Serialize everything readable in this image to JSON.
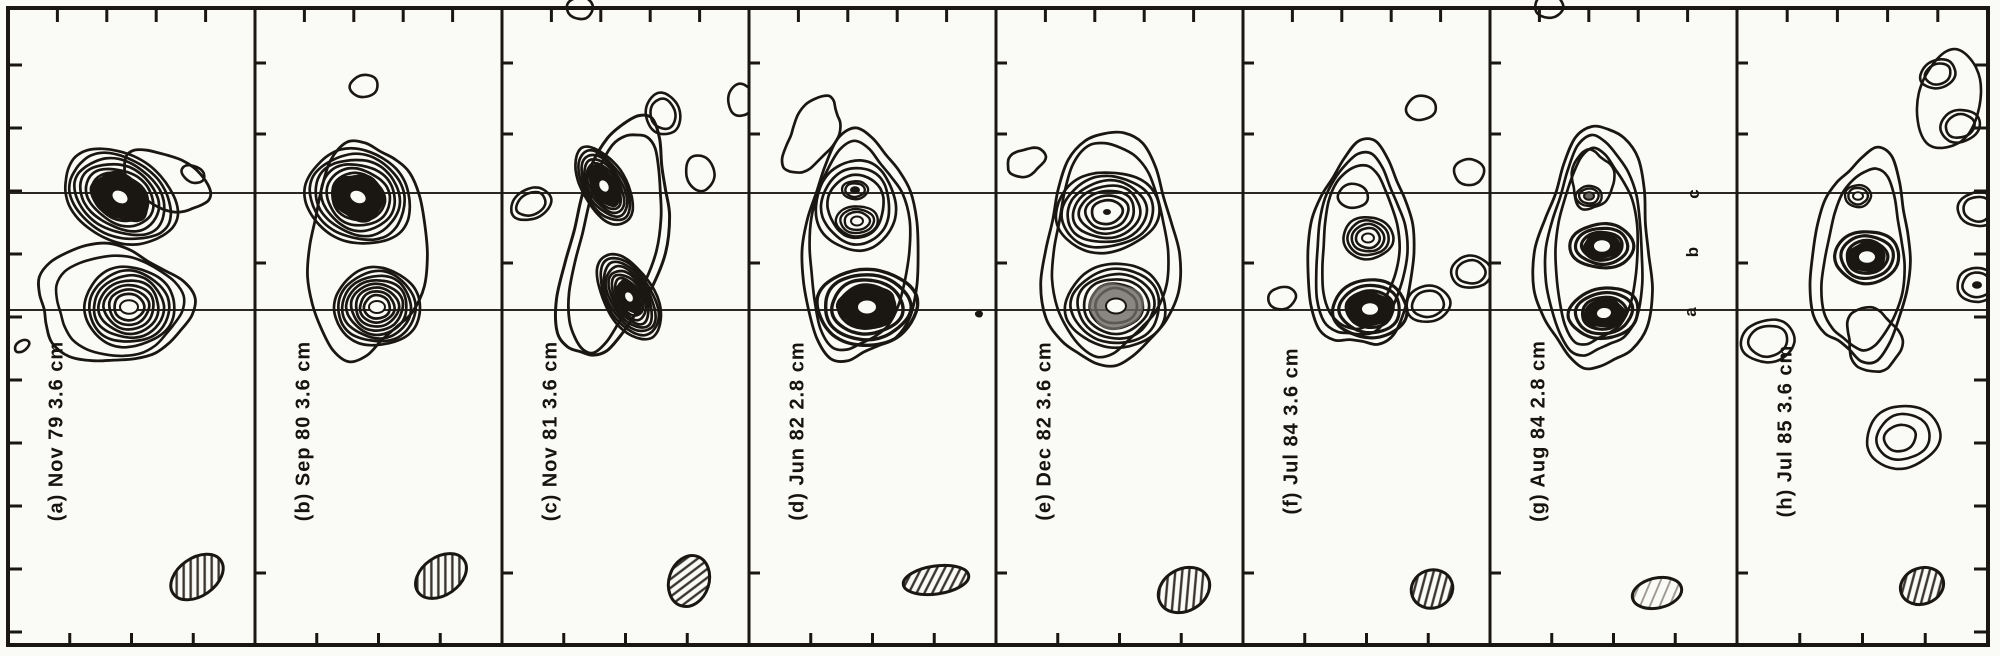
{
  "figure": {
    "title": "Multi-epoch VLBI contour maps, panels (a)-(h)",
    "colors": {
      "ink": "#1a1712",
      "paper": "#fafaf7",
      "gray": "#6e6a64",
      "refline": "#2b2823",
      "hatch": "#3a352e",
      "hatch_light": "#9a958d"
    }
  },
  "chart_data": {
    "type": "contour-map-series",
    "title": "Eight epoch radio interferometry contour maps of a compact double/triple source",
    "component_letters": [
      {
        "text": "c",
        "x": 1694,
        "y": 194
      },
      {
        "text": "b",
        "x": 1693,
        "y": 252
      },
      {
        "text": "a",
        "x": 1691,
        "y": 312
      }
    ],
    "reference_lines": {
      "y": [
        193,
        310
      ],
      "x0": 8,
      "x1": 1988
    },
    "axes": {
      "border": {
        "x0": 8,
        "y0": 8,
        "x1": 1988,
        "y1": 645
      },
      "panel_borders_x": [
        8,
        255,
        502,
        749,
        996,
        1243,
        1490,
        1737,
        1988
      ],
      "top_tick_fracs": [
        0.2,
        0.4,
        0.6,
        0.8
      ],
      "bottom_tick_fracs": [
        0.25,
        0.5,
        0.75
      ],
      "edge_tick_start": 65,
      "edge_tick_step": 63,
      "edge_tick_count": 10,
      "inner_border_ticks_y": [
        63,
        134,
        263,
        573
      ]
    },
    "panels": [
      {
        "id": "a",
        "label": "(a) Nov 79  3.6 cm",
        "epoch": "Nov 79",
        "wavelength": "3.6 cm",
        "label_pos": {
          "x": 57,
          "y": 431
        },
        "env": [
          {
            "cx": 112,
            "cy": 304,
            "rx": 77,
            "ry": 58,
            "rot": 8,
            "amp": 0.11,
            "sw": 2.8
          },
          {
            "cx": 118,
            "cy": 305,
            "rx": 63,
            "ry": 50,
            "rot": 5,
            "amp": 0.07,
            "sw": 2.6
          },
          {
            "cx": 166,
            "cy": 181,
            "rx": 46,
            "ry": 26,
            "rot": 25,
            "amp": 0.07,
            "sw": 2.8
          }
        ],
        "src": [
          {
            "cx": 120,
            "cy": 197,
            "rx": 60,
            "ry": 43,
            "rot": 30,
            "rings": 7,
            "min": 0.3,
            "dark": 0.52,
            "core": "white",
            "coreR": 9,
            "sw": 2.7
          },
          {
            "cx": 129,
            "cy": 307,
            "rx": 45,
            "ry": 40,
            "rot": 0,
            "rings": 7,
            "min": 0.22,
            "core": "white",
            "coreR": 9,
            "sw": 2.7
          }
        ],
        "iso": [
          {
            "cx": 193,
            "cy": 174,
            "rx": 12,
            "ry": 8,
            "rot": 25,
            "rings": 1
          },
          {
            "cx": 22,
            "cy": 346,
            "rx": 8,
            "ry": 5,
            "rot": -35,
            "rings": 1
          }
        ],
        "beam": {
          "cx": 197,
          "cy": 577,
          "rx": 29,
          "ry": 19,
          "rot": -35,
          "hatch": "dark"
        }
      },
      {
        "id": "b",
        "label": "(b) Sep 80  3.6 cm",
        "epoch": "Sep 80",
        "wavelength": "3.6 cm",
        "label_pos": {
          "x": 304,
          "y": 431
        },
        "env": [
          {
            "cx": 366,
            "cy": 250,
            "rx": 59,
            "ry": 107,
            "rot": 4,
            "amp": 0.1,
            "sw": 2.8
          }
        ],
        "src": [
          {
            "cx": 358,
            "cy": 197,
            "rx": 54,
            "ry": 46,
            "rot": 25,
            "rings": 7,
            "min": 0.3,
            "dark": 0.5,
            "core": "white",
            "coreR": 9,
            "sw": 2.7
          },
          {
            "cx": 377,
            "cy": 307,
            "rx": 43,
            "ry": 39,
            "rot": 0,
            "rings": 8,
            "min": 0.2,
            "core": "white",
            "coreR": 8,
            "sw": 2.7
          }
        ],
        "iso": [
          {
            "cx": 364,
            "cy": 86,
            "rx": 14,
            "ry": 11,
            "rot": -10,
            "rings": 1
          }
        ],
        "beam": {
          "cx": 441,
          "cy": 576,
          "rx": 28,
          "ry": 19,
          "rot": -35,
          "hatch": "dark"
        }
      },
      {
        "id": "c",
        "label": "(c) Nov 81  3.6 cm",
        "epoch": "Nov 81",
        "wavelength": "3.6 cm",
        "label_pos": {
          "x": 551,
          "y": 431
        },
        "env": [
          {
            "cx": 615,
            "cy": 240,
            "rx": 47,
            "ry": 123,
            "rot": 14,
            "amp": 0.12,
            "sw": 3.0
          },
          {
            "cx": 616,
            "cy": 241,
            "rx": 38,
            "ry": 112,
            "rot": 14,
            "amp": 0.1,
            "sw": 2.8
          }
        ],
        "src": [
          {
            "cx": 604,
            "cy": 186,
            "rx": 43,
            "ry": 22,
            "rot": 60,
            "rings": 7,
            "min": 0.28,
            "dark": 0.55,
            "core": "white",
            "coreR": 7,
            "sw": 2.7
          },
          {
            "cx": 629,
            "cy": 297,
            "rx": 47,
            "ry": 25,
            "rot": 60,
            "rings": 8,
            "min": 0.25,
            "dark": 0.4,
            "core": "white",
            "coreR": 6,
            "sw": 2.7
          }
        ],
        "iso": [
          {
            "cx": 663,
            "cy": 114,
            "rx": 17,
            "ry": 21,
            "rot": -15,
            "rings": 2
          },
          {
            "cx": 700,
            "cy": 173,
            "rx": 14,
            "ry": 18,
            "rot": -12,
            "rings": 1
          },
          {
            "cx": 531,
            "cy": 204,
            "rx": 21,
            "ry": 15,
            "rot": -25,
            "rings": 2
          },
          {
            "cx": 741,
            "cy": 100,
            "rx": 13,
            "ry": 16,
            "rot": 0,
            "rings": 1
          },
          {
            "cx": 580,
            "cy": 8,
            "rx": 13,
            "ry": 11,
            "rot": 0,
            "rings": 1
          }
        ],
        "beam": {
          "cx": 689,
          "cy": 581,
          "rx": 20,
          "ry": 26,
          "rot": 18,
          "hatch": "dark"
        }
      },
      {
        "id": "d",
        "label": "(d) Jun 82  2.8 cm",
        "epoch": "Jun 82",
        "wavelength": "2.8 cm",
        "label_pos": {
          "x": 798,
          "y": 431
        },
        "env": [
          {
            "cx": 860,
            "cy": 250,
            "rx": 58,
            "ry": 113,
            "rot": 2,
            "amp": 0.1,
            "sw": 2.8
          },
          {
            "cx": 858,
            "cy": 248,
            "rx": 50,
            "ry": 102,
            "rot": 2,
            "amp": 0.085,
            "sw": 2.7
          },
          {
            "cx": 812,
            "cy": 135,
            "rx": 22,
            "ry": 42,
            "rot": 28,
            "amp": 0.13,
            "sw": 2.7
          }
        ],
        "src": [
          {
            "cx": 856,
            "cy": 206,
            "rx": 40,
            "ry": 45,
            "rot": 0,
            "rings": 3,
            "min": 0.55,
            "sw": 2.7
          },
          {
            "cx": 855,
            "cy": 190,
            "rx": 13,
            "ry": 9,
            "rot": 0,
            "rings": 2,
            "min": 0.5,
            "core": "dot",
            "coreR": 5,
            "sw": 2.4
          },
          {
            "cx": 857,
            "cy": 221,
            "rx": 21,
            "ry": 15,
            "rot": 0,
            "rings": 3,
            "min": 0.4,
            "core": "white",
            "coreR": 6,
            "sw": 2.4
          },
          {
            "cx": 867,
            "cy": 307,
            "rx": 50,
            "ry": 38,
            "rot": 0,
            "rings": 4,
            "min": 0.42,
            "dark": 0.58,
            "core": "white",
            "coreR": 10,
            "sw": 3.4
          }
        ],
        "iso": [
          {
            "cx": 979,
            "cy": 314,
            "rx": 4,
            "ry": 3.5,
            "rot": 0,
            "rings": 1,
            "fill": true
          }
        ],
        "beam": {
          "cx": 936,
          "cy": 580,
          "rx": 33,
          "ry": 14,
          "rot": -8,
          "hatch": "dark"
        }
      },
      {
        "id": "e",
        "label": "(e) Dec 82  3.6 cm",
        "epoch": "Dec 82",
        "wavelength": "3.6 cm",
        "label_pos": {
          "x": 1045,
          "y": 431
        },
        "env": [
          {
            "cx": 1110,
            "cy": 252,
            "rx": 67,
            "ry": 117,
            "rot": 2,
            "amp": 0.1,
            "sw": 2.8
          },
          {
            "cx": 1109,
            "cy": 250,
            "rx": 57,
            "ry": 106,
            "rot": 2,
            "amp": 0.08,
            "sw": 2.7
          },
          {
            "cx": 1026,
            "cy": 162,
            "rx": 20,
            "ry": 13,
            "rot": -25,
            "amp": 0.1,
            "sw": 2.7
          }
        ],
        "src": [
          {
            "cx": 1107,
            "cy": 212,
            "rx": 52,
            "ry": 40,
            "rot": -8,
            "rings": 7,
            "min": 0.18,
            "core": "dot",
            "coreR": 4,
            "sw": 2.7
          },
          {
            "cx": 1116,
            "cy": 306,
            "rx": 50,
            "ry": 42,
            "rot": 0,
            "rings": 6,
            "min": 0.3,
            "gray": 0.55,
            "core": "white",
            "coreR": 10,
            "sw": 2.7
          }
        ],
        "iso": [],
        "beam": {
          "cx": 1184,
          "cy": 590,
          "rx": 27,
          "ry": 21,
          "rot": -30,
          "hatch": "dark"
        }
      },
      {
        "id": "f",
        "label": "(f) Jul 84  3.6 cm",
        "epoch": "Jul 84",
        "wavelength": "3.6 cm",
        "label_pos": {
          "x": 1292,
          "y": 431
        },
        "env": [
          {
            "cx": 1361,
            "cy": 250,
            "rx": 53,
            "ry": 101,
            "rot": 3,
            "amp": 0.11,
            "sw": 2.8
          },
          {
            "cx": 1360,
            "cy": 249,
            "rx": 45,
            "ry": 91,
            "rot": 3,
            "amp": 0.09,
            "sw": 2.7
          },
          {
            "cx": 1359,
            "cy": 248,
            "rx": 38,
            "ry": 82,
            "rot": 3,
            "amp": 0.07,
            "sw": 2.7
          }
        ],
        "src": [
          {
            "cx": 1353,
            "cy": 196,
            "rx": 15,
            "ry": 12,
            "rot": 0,
            "rings": 1,
            "sw": 2.6
          },
          {
            "cx": 1368,
            "cy": 238,
            "rx": 25,
            "ry": 21,
            "rot": 0,
            "rings": 4,
            "min": 0.3,
            "core": "white",
            "coreR": 6,
            "sw": 2.6
          },
          {
            "cx": 1370,
            "cy": 309,
            "rx": 37,
            "ry": 29,
            "rot": 0,
            "rings": 3,
            "min": 0.45,
            "dark": 0.62,
            "core": "white",
            "coreR": 9,
            "sw": 3.2
          }
        ],
        "iso": [
          {
            "cx": 1421,
            "cy": 108,
            "rx": 15,
            "ry": 12,
            "rot": -10,
            "rings": 1
          },
          {
            "cx": 1469,
            "cy": 172,
            "rx": 15,
            "ry": 13,
            "rot": 0,
            "rings": 1
          },
          {
            "cx": 1471,
            "cy": 272,
            "rx": 20,
            "ry": 16,
            "rot": 0,
            "rings": 2
          },
          {
            "cx": 1282,
            "cy": 298,
            "rx": 14,
            "ry": 11,
            "rot": -15,
            "rings": 1
          },
          {
            "cx": 1428,
            "cy": 304,
            "rx": 22,
            "ry": 18,
            "rot": -10,
            "rings": 2
          }
        ],
        "beam": {
          "cx": 1432,
          "cy": 589,
          "rx": 21,
          "ry": 19,
          "rot": -20,
          "hatch": "dark"
        }
      },
      {
        "id": "g",
        "label": "(g) Aug 84  2.8 cm",
        "epoch": "Aug 84",
        "wavelength": "2.8 cm",
        "label_pos": {
          "x": 1539,
          "y": 431
        },
        "env": [
          {
            "cx": 1596,
            "cy": 252,
            "rx": 57,
            "ry": 121,
            "rot": 2,
            "amp": 0.13,
            "sw": 2.8
          },
          {
            "cx": 1595,
            "cy": 251,
            "rx": 48,
            "ry": 108,
            "rot": 2,
            "amp": 0.1,
            "sw": 2.7
          },
          {
            "cx": 1596,
            "cy": 250,
            "rx": 41,
            "ry": 96,
            "rot": 2,
            "amp": 0.08,
            "sw": 2.7
          },
          {
            "cx": 1592,
            "cy": 180,
            "rx": 21,
            "ry": 29,
            "rot": 0,
            "amp": 0.12,
            "sw": 2.6
          }
        ],
        "src": [
          {
            "cx": 1589,
            "cy": 196,
            "rx": 13,
            "ry": 10,
            "rot": 0,
            "rings": 2,
            "min": 0.5,
            "core": "graydot",
            "coreR": 5,
            "sw": 2.4
          },
          {
            "cx": 1602,
            "cy": 246,
            "rx": 32,
            "ry": 22,
            "rot": 0,
            "rings": 3,
            "min": 0.45,
            "dark": 0.6,
            "core": "white",
            "coreR": 9,
            "sw": 3.2
          },
          {
            "cx": 1604,
            "cy": 313,
            "rx": 35,
            "ry": 25,
            "rot": -8,
            "rings": 3,
            "min": 0.45,
            "dark": 0.6,
            "core": "white",
            "coreR": 8,
            "sw": 3.2
          }
        ],
        "iso": [
          {
            "cx": 1549,
            "cy": 6,
            "rx": 14,
            "ry": 12,
            "rot": 0,
            "rings": 1
          }
        ],
        "beam": {
          "cx": 1657,
          "cy": 593,
          "rx": 25,
          "ry": 15,
          "rot": -12,
          "hatch": "light"
        }
      },
      {
        "id": "h",
        "label": "(h) Jul 85  3.6 cm",
        "epoch": "Jul 85",
        "wavelength": "3.6 cm",
        "label_pos": {
          "x": 1786,
          "y": 431
        },
        "env": [
          {
            "cx": 1862,
            "cy": 258,
            "rx": 49,
            "ry": 103,
            "rot": 4,
            "amp": 0.12,
            "sw": 2.8
          },
          {
            "cx": 1864,
            "cy": 262,
            "rx": 40,
            "ry": 90,
            "rot": 4,
            "amp": 0.09,
            "sw": 2.7
          },
          {
            "cx": 1873,
            "cy": 340,
            "rx": 26,
            "ry": 33,
            "rot": -20,
            "amp": 0.12,
            "sw": 2.7
          }
        ],
        "src": [
          {
            "cx": 1858,
            "cy": 196,
            "rx": 13,
            "ry": 11,
            "rot": 0,
            "rings": 2,
            "min": 0.5,
            "core": "white",
            "coreR": 5,
            "sw": 2.4
          },
          {
            "cx": 1867,
            "cy": 257,
            "rx": 32,
            "ry": 26,
            "rot": 0,
            "rings": 3,
            "min": 0.45,
            "dark": 0.6,
            "core": "white",
            "coreR": 9,
            "sw": 3.2
          }
        ],
        "iso": [
          {
            "cx": 1949,
            "cy": 100,
            "rx": 31,
            "ry": 50,
            "rot": 12,
            "rings": 1
          },
          {
            "cx": 1938,
            "cy": 74,
            "rx": 18,
            "ry": 14,
            "rot": -20,
            "rings": 2
          },
          {
            "cx": 1960,
            "cy": 126,
            "rx": 20,
            "ry": 16,
            "rot": -15,
            "rings": 2
          },
          {
            "cx": 1978,
            "cy": 209,
            "rx": 20,
            "ry": 17,
            "rot": 0,
            "rings": 2
          },
          {
            "cx": 1977,
            "cy": 285,
            "rx": 20,
            "ry": 17,
            "rot": 0,
            "rings": 2,
            "core": "dot",
            "coreR": 5
          },
          {
            "cx": 1768,
            "cy": 341,
            "rx": 27,
            "ry": 21,
            "rot": -10,
            "rings": 2
          },
          {
            "cx": 1903,
            "cy": 437,
            "rx": 37,
            "ry": 31,
            "rot": -15,
            "rings": 2
          },
          {
            "cx": 1900,
            "cy": 438,
            "rx": 16,
            "ry": 13,
            "rot": -15,
            "rings": 1
          }
        ],
        "beam": {
          "cx": 1922,
          "cy": 586,
          "rx": 22,
          "ry": 18,
          "rot": -20,
          "hatch": "dark"
        }
      }
    ]
  }
}
